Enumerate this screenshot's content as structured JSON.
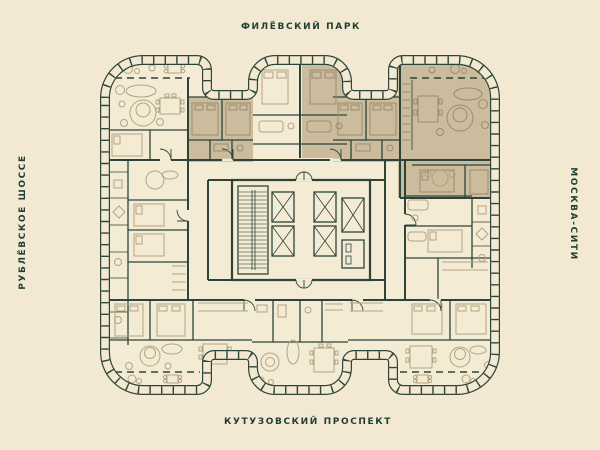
{
  "street_labels": {
    "top": "ФИЛЁВСКИЙ ПАРК",
    "bottom": "КУТУЗОВСКИЙ ПРОСПЕКТ",
    "left": "РУБЛЁВСКОЕ ШОССЕ",
    "right": "МОСКВА-СИТИ"
  },
  "palette": {
    "background": "#f3e9d2",
    "floor_fill": "#f4ebd5",
    "highlight_fill": "#cbbc9e",
    "wall_color": "#2c443a",
    "furniture_color": "#b3a382",
    "label_color": "#1e3f32"
  },
  "plan": {
    "kind": "residential floor plan",
    "highlighted_zones": 4,
    "core_features": [
      "staircase",
      "elevator-shafts",
      "central-corridor"
    ]
  }
}
